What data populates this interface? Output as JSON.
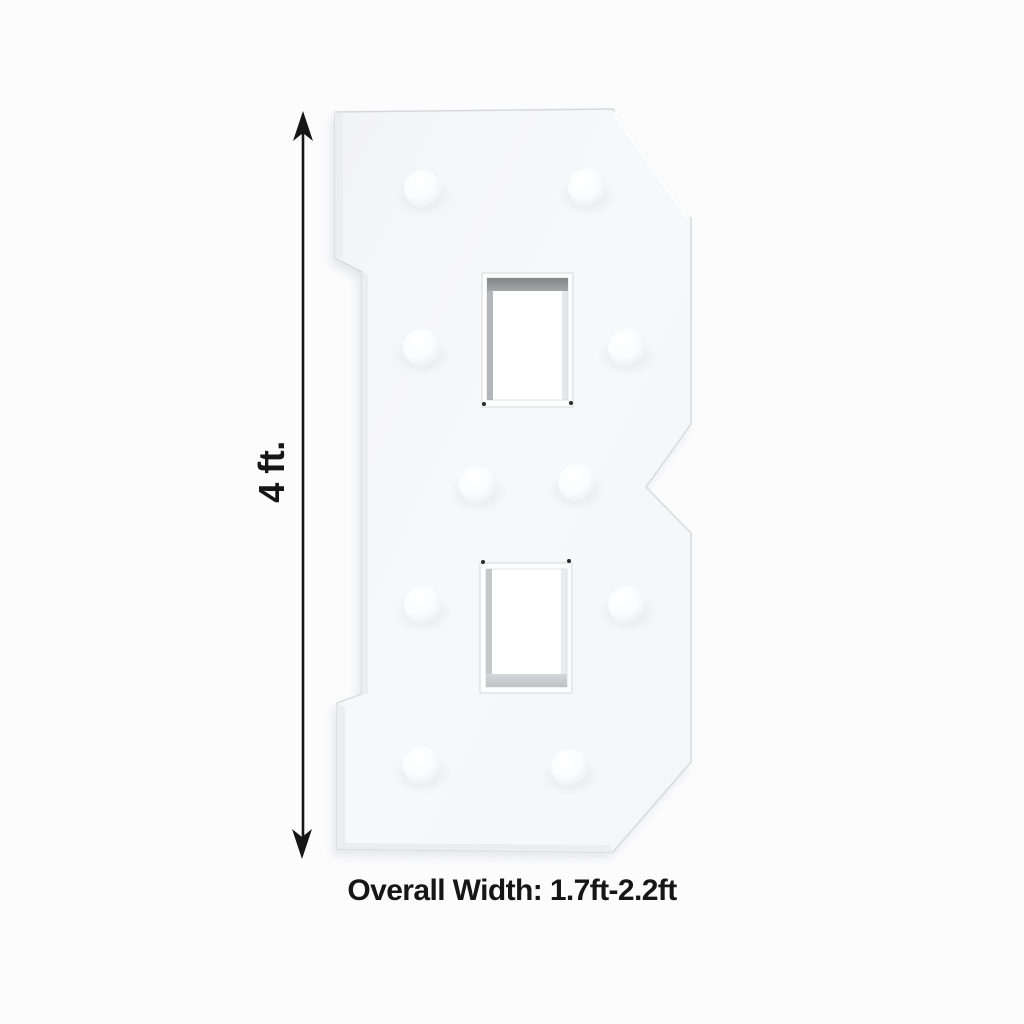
{
  "diagram": {
    "letter": "B",
    "bulb_count": 10,
    "height_label": "4 ft.",
    "width_caption": "Overall Width: 1.7ft-2.2ft",
    "colors": {
      "background": "#fcfcfd",
      "letter_face": "#f6f7f9",
      "letter_edge": "#d6d8db",
      "hole_wall_dark": "#8b8d90",
      "hole_wall_light": "#c9cccf",
      "annotation_text": "#161616"
    }
  }
}
